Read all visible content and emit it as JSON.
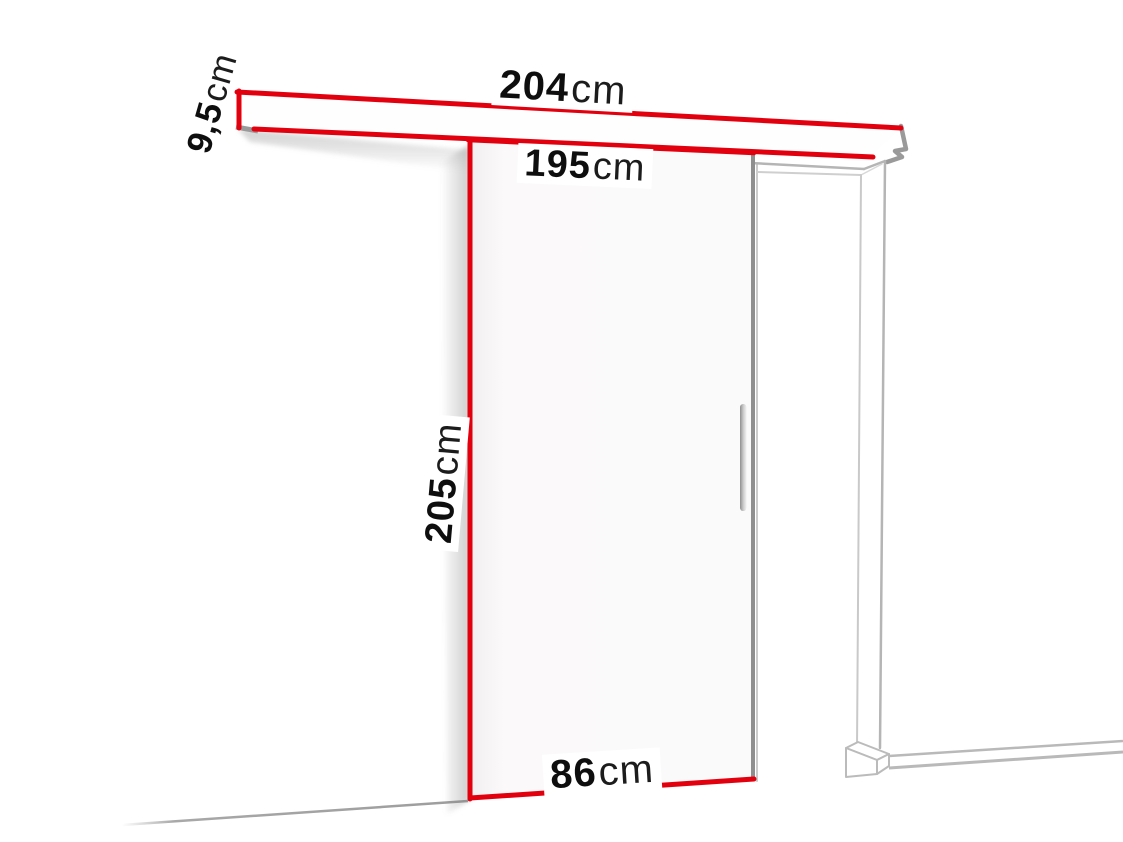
{
  "diagram": {
    "name": "sliding-door-dimension-diagram",
    "dimensions": {
      "rail_width": {
        "value": "204",
        "unit": "cm"
      },
      "rail_height": {
        "value": "9,5",
        "unit": "cm"
      },
      "inner_width": {
        "value": "195",
        "unit": "cm"
      },
      "door_height": {
        "value": "205",
        "unit": "cm"
      },
      "door_width": {
        "value": "86",
        "unit": "cm"
      }
    },
    "colors": {
      "dimension_red": "#e2000e",
      "frame_gray": "#b5b5b5",
      "edge_gray": "#8f8f8f",
      "text_black": "#0e0e0e",
      "door_fill": "#faf8f8"
    }
  }
}
